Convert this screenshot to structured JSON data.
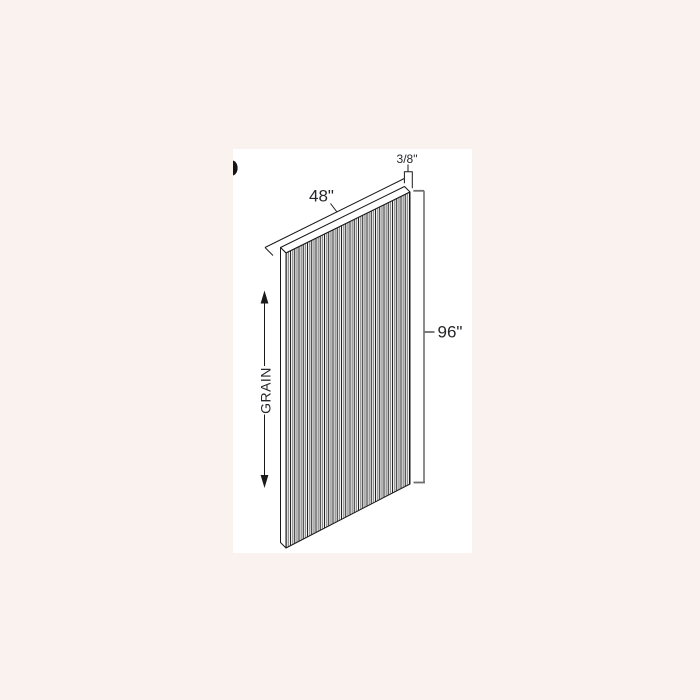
{
  "page": {
    "background": "#faf2ef",
    "sheet_background": "#ffffff"
  },
  "colors": {
    "line": "#1a1a1a",
    "grain_secondary": "#8c8c8c",
    "tick_gray": "#6e6e6e",
    "text": "#26262a"
  },
  "diagram": {
    "type": "panel-dimension-drawing",
    "labels": {
      "width": "48\"",
      "thickness": "3/8\"",
      "height": "96\"",
      "grain": "GRAIN"
    }
  }
}
